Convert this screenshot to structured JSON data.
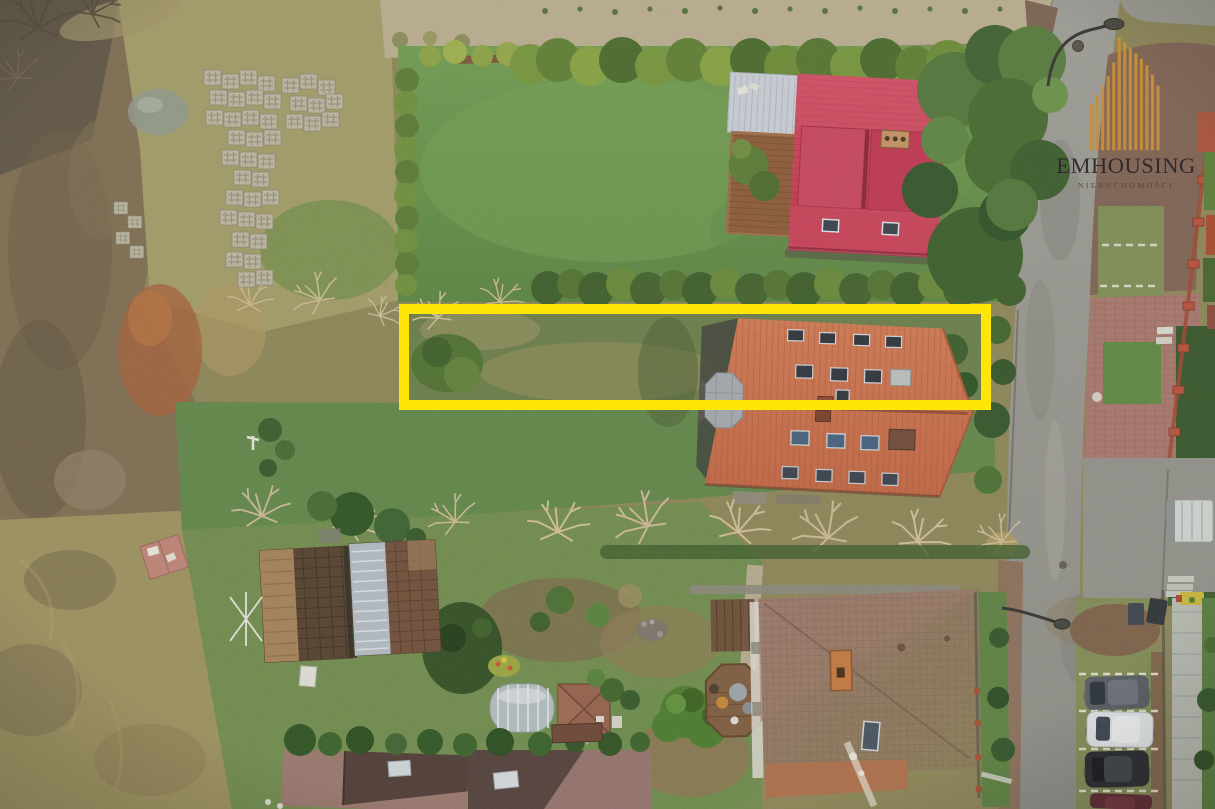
{
  "watermark": {
    "brand": "EMHOUSING",
    "subtitle": "NIERUCHOMOŚCI",
    "bar_color": "#c89038",
    "text_color": "#2b2328",
    "subtitle_color": "#4e3d36"
  },
  "highlight": {
    "color": "#ffe608",
    "shape": "rectangle"
  },
  "scene_colors": {
    "lawn": "#649a4e",
    "dry_meadow": "#9f9a66",
    "red_metal_roof": "#c43d54",
    "orange_tile_roof": "#c7714e",
    "brown_tile_roof": "#8f6d5e",
    "asphalt_road": "#969590",
    "mulch": "#7e6252"
  }
}
